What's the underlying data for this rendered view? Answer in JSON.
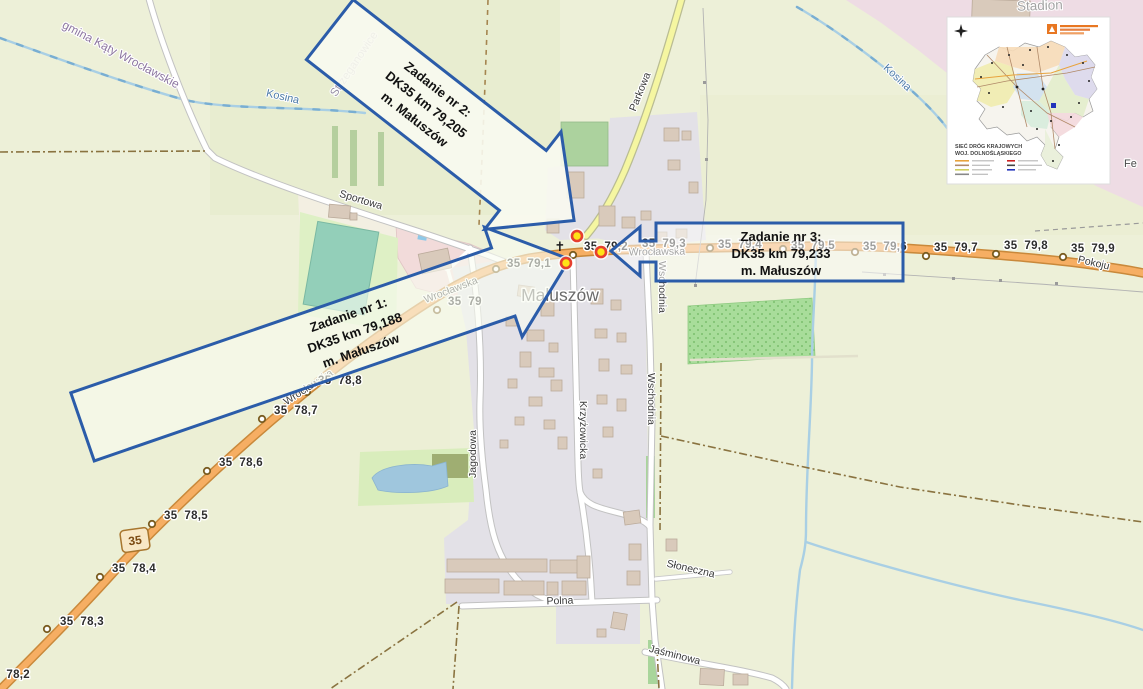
{
  "map": {
    "town": "Małuszów",
    "region_labels": {
      "municipality": "gmina Kąty Wrocławskie",
      "village_nw": "Strzeganowice",
      "stream_west": "Kosina",
      "stream_east": "Kosina",
      "stadium": "Stadion",
      "edge_cut": "Fe"
    },
    "streets": {
      "sportowa": "Sportowa",
      "parkowa": "Parkowa",
      "wroclawska": "Wrocławska",
      "pokoju": "Pokoju",
      "jagodowa": "Jagodowa",
      "krzyzowicka": "Krzyżowicka",
      "wschodnia": "Wschodnia",
      "polna": "Polna",
      "sloneczna": "Słoneczna",
      "jasminowa": "Jaśminowa"
    },
    "route_shield": "35",
    "church_symbol": "✝",
    "km": [
      "35  78,2",
      "35  78,3",
      "35  78,4",
      "35  78,5",
      "35  78,6",
      "35  78,7",
      "35  78,8",
      "35  79",
      "35  79,1",
      "35  79,2",
      "35  79,3",
      "35  79,4",
      "35  79,5",
      "35  79,6",
      "35  79,7",
      "35  79,8",
      "35  79,9"
    ]
  },
  "callouts": [
    {
      "title": "Zadanie nr 1:",
      "road_km": "DK35 km 79,188",
      "place": "m. Małuszów"
    },
    {
      "title": "Zadanie nr 2:",
      "road_km": "DK35 km 79,205",
      "place": "m. Małuszów"
    },
    {
      "title": "Zadanie nr 3:",
      "road_km": "DK35 km 79,233",
      "place": "m. Małuszów"
    }
  ],
  "inset": {
    "title_line1": "SIEĆ DRÓG KRAJOWYCH",
    "title_line2": "WOJ. DOLNOŚLĄSKIEGO"
  },
  "colors": {
    "callout_border": "#2b5ca9",
    "marker_fill": "#ffe317",
    "marker_ring": "#e63f2e",
    "road_dk35": "#f6ae63",
    "road_tertiary": "#f5f6a1",
    "residential": "#e3e1e7",
    "land": "#edf0d8"
  }
}
